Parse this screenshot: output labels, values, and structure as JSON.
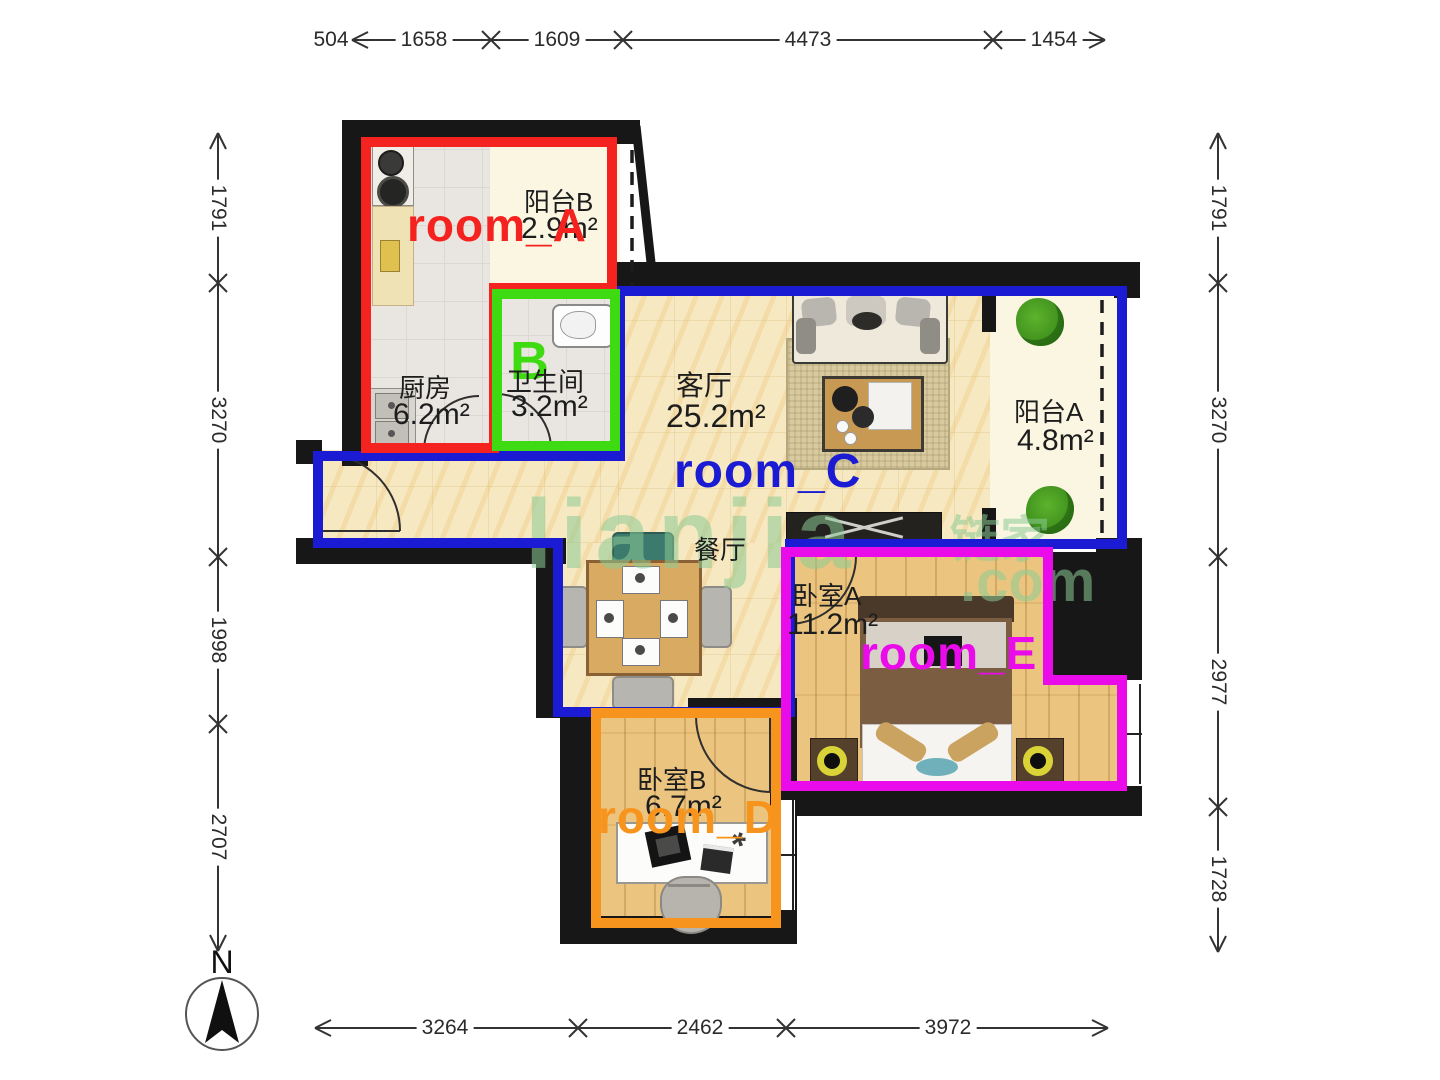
{
  "dimensions": {
    "top": [
      "504",
      "1658",
      "1609",
      "4473",
      "1454"
    ],
    "bottom": [
      "3264",
      "2462",
      "3972"
    ],
    "left": [
      "1791",
      "3270",
      "1998",
      "2707"
    ],
    "right": [
      "1791",
      "3270",
      "2977",
      "1728"
    ]
  },
  "rooms": {
    "balcony_b": {
      "name": "阳台B",
      "area": "2.9m²"
    },
    "kitchen": {
      "name": "厨房",
      "area": "6.2m²"
    },
    "bathroom": {
      "name": "卫生间",
      "area": "3.2m²"
    },
    "living": {
      "name": "客厅",
      "area": "25.2m²"
    },
    "balcony_a": {
      "name": "阳台A",
      "area": "4.8m²"
    },
    "dining": {
      "name": "餐厅"
    },
    "bedroom_a": {
      "name": "卧室A",
      "area": "11.2m²"
    },
    "bedroom_b": {
      "name": "卧室B",
      "area": "6.7m²"
    }
  },
  "annotations": {
    "room_a": {
      "label": "room_A",
      "color": "#f5231f"
    },
    "room_b": {
      "label": "B",
      "color": "#3fdb12"
    },
    "room_c": {
      "label": "room_C",
      "color": "#1b1bd4"
    },
    "room_d": {
      "label": "room_D",
      "color": "#f7941e"
    },
    "room_e": {
      "label": "room_E",
      "color": "#ea0bea"
    }
  },
  "compass": {
    "label": "N"
  },
  "watermark": {
    "text": "lianjia",
    "cn": "链家",
    "suffix": ".com"
  }
}
